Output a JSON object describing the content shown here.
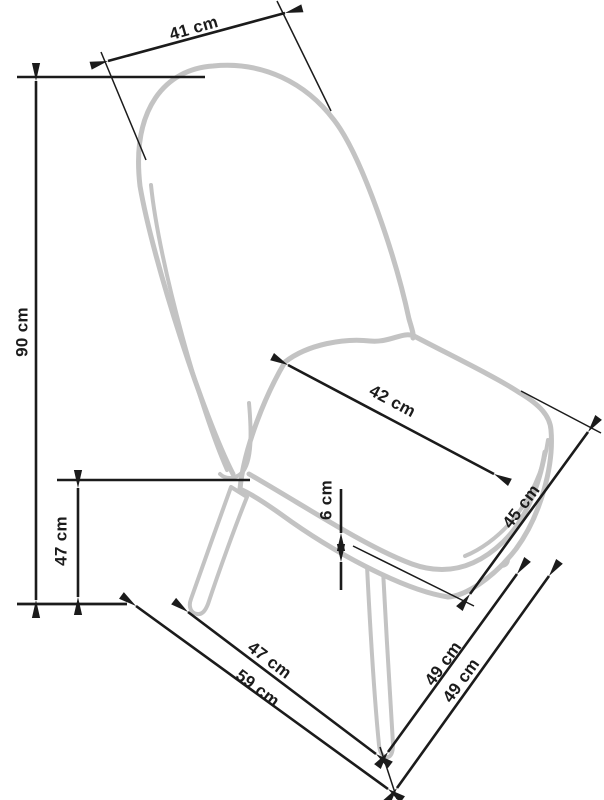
{
  "diagram": {
    "type": "technical-drawing",
    "subject": "upholstered chair with tapered legs - dimension drawing",
    "unit": "cm",
    "colors": {
      "outline": "#c3c3c3",
      "dimension": "#1b1b1b",
      "background": "#ffffff"
    },
    "dimensions": [
      {
        "name": "backrest-width",
        "value": 41,
        "label": "41 cm",
        "label_pos": {
          "x": 194,
          "y": 29,
          "rotate": -16
        },
        "lines": [
          {
            "x1": 108,
            "y1": 61,
            "x2": 285,
            "y2": 13,
            "arrows": "both"
          }
        ],
        "extensions": [
          {
            "x1": 101,
            "y1": 52,
            "x2": 146,
            "y2": 160
          },
          {
            "x1": 277,
            "y1": 1,
            "x2": 331,
            "y2": 111
          }
        ]
      },
      {
        "name": "overall-height",
        "value": 90,
        "label": "90 cm",
        "label_pos": {
          "x": 23,
          "y": 332,
          "rotate": -90
        },
        "lines": [
          {
            "x1": 36,
            "y1": 81,
            "x2": 36,
            "y2": 600,
            "arrows": "both"
          }
        ],
        "extensions": [
          {
            "x1": 17,
            "y1": 77,
            "x2": 205,
            "y2": 77,
            "w": 2.4
          },
          {
            "x1": 17,
            "y1": 604,
            "x2": 127,
            "y2": 604,
            "w": 2.8
          }
        ]
      },
      {
        "name": "seat-height",
        "value": 47,
        "label": "47 cm",
        "label_pos": {
          "x": 62,
          "y": 541,
          "rotate": -90
        },
        "lines": [
          {
            "x1": 78,
            "y1": 488,
            "x2": 78,
            "y2": 597,
            "arrows": "both"
          }
        ],
        "extensions": [
          {
            "x1": 57,
            "y1": 480,
            "x2": 250,
            "y2": 480,
            "w": 2.4
          }
        ]
      },
      {
        "name": "seat-depth",
        "value": 42,
        "label": "42 cm",
        "label_pos": {
          "x": 392,
          "y": 402,
          "rotate": 28
        },
        "lines": [
          {
            "x1": 288,
            "y1": 365,
            "x2": 494,
            "y2": 474,
            "arrows": "both"
          }
        ],
        "extensions": []
      },
      {
        "name": "cushion-thickness",
        "value": 6,
        "label": "6 cm",
        "label_pos": {
          "x": 327,
          "y": 500,
          "rotate": -90
        },
        "lines": [
          {
            "x1": 341,
            "y1": 489,
            "x2": 341,
            "y2": 533,
            "arrows": "end"
          },
          {
            "x1": 341,
            "y1": 590,
            "x2": 341,
            "y2": 562,
            "arrows": "end"
          }
        ],
        "extensions": []
      },
      {
        "name": "seat-side-depth",
        "value": 45,
        "label": "45 cm",
        "label_pos": {
          "x": 522,
          "y": 507,
          "rotate": -53
        },
        "lines": [
          {
            "x1": 470,
            "y1": 594,
            "x2": 588,
            "y2": 432,
            "arrows": "both"
          }
        ],
        "extensions": [
          {
            "x1": 353,
            "y1": 546,
            "x2": 474,
            "y2": 606
          },
          {
            "x1": 521,
            "y1": 391,
            "x2": 601,
            "y2": 433
          }
        ]
      },
      {
        "name": "front-leg-span",
        "value": 47,
        "label": "47 cm",
        "label_pos": {
          "x": 269,
          "y": 661,
          "rotate": 37
        },
        "lines": [
          {
            "x1": 188,
            "y1": 612,
            "x2": 376,
            "y2": 754,
            "arrows": "both"
          }
        ],
        "extensions": []
      },
      {
        "name": "base-width",
        "value": 59,
        "label": "59 cm",
        "label_pos": {
          "x": 257,
          "y": 689,
          "rotate": 37
        },
        "lines": [
          {
            "x1": 136,
            "y1": 606,
            "x2": 388,
            "y2": 789,
            "arrows": "both"
          }
        ],
        "extensions": []
      },
      {
        "name": "side-leg-span",
        "value": 49,
        "label": "49 cm",
        "label_pos": {
          "x": 444,
          "y": 664,
          "rotate": -54
        },
        "lines": [
          {
            "x1": 388,
            "y1": 752,
            "x2": 517,
            "y2": 574,
            "arrows": "both"
          }
        ],
        "extensions": []
      },
      {
        "name": "base-depth",
        "value": 49,
        "label": "49 cm",
        "label_pos": {
          "x": 462,
          "y": 681,
          "rotate": -54
        },
        "lines": [
          {
            "x1": 397,
            "y1": 788,
            "x2": 549,
            "y2": 576,
            "arrows": "both"
          }
        ],
        "extensions": [
          {
            "x1": 380,
            "y1": 747,
            "x2": 397,
            "y2": 799
          }
        ]
      }
    ]
  }
}
